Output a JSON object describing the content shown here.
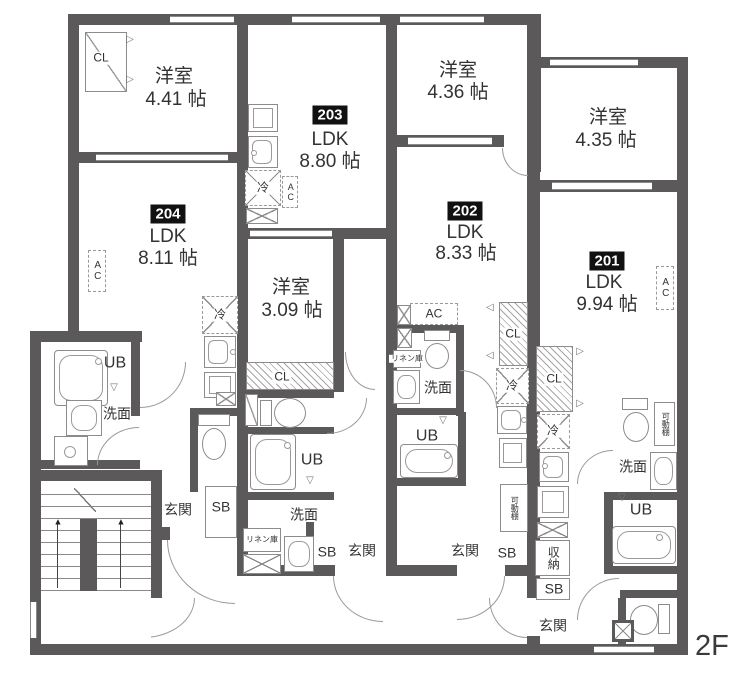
{
  "floor_label": "2F",
  "units": {
    "u201": {
      "number": "201",
      "ldk_label": "LDK",
      "ldk_size": "9.94 帖",
      "bedroom_label": "洋室",
      "bedroom_size": "4.35 帖"
    },
    "u202": {
      "number": "202",
      "ldk_label": "LDK",
      "ldk_size": "8.33 帖",
      "bedroom_label": "洋室",
      "bedroom_size": "4.36 帖"
    },
    "u203": {
      "number": "203",
      "ldk_label": "LDK",
      "ldk_size": "8.80 帖",
      "bedroom_label": "洋室",
      "bedroom_size": "3.09 帖"
    },
    "u204": {
      "number": "204",
      "ldk_label": "LDK",
      "ldk_size": "8.11 帖",
      "bedroom_label": "洋室",
      "bedroom_size": "4.41 帖"
    }
  },
  "labels": {
    "closet": "CL",
    "unit_bath": "UB",
    "shoe_box": "SB",
    "washroom": "洗面",
    "entrance": "玄関",
    "refrigerator": "冷",
    "air_conditioner": "AC",
    "linen_closet": "リネン庫",
    "movable_shelf": "可動棚",
    "storage": "収納"
  },
  "icons": {
    "up_arrow": "▲",
    "door_triangle_down": "▽",
    "door_triangle_left": "◁",
    "door_triangle_right": "▷"
  },
  "colors": {
    "wall": "#5b5959",
    "fixture_line": "#8c8c8c",
    "badge_bg": "#111111",
    "badge_text": "#ffffff"
  }
}
